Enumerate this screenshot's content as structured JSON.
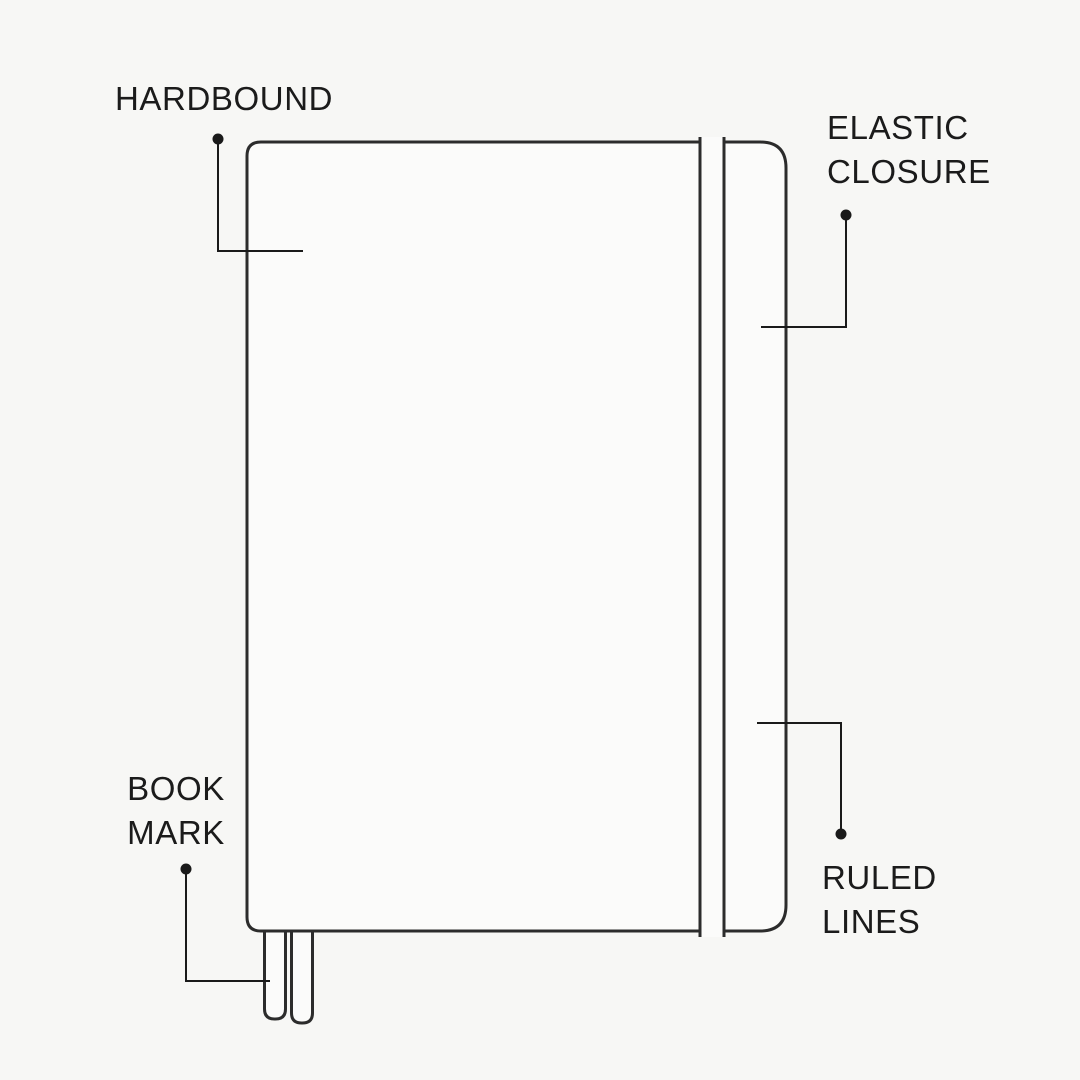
{
  "page": {
    "background_color": "#f7f7f5",
    "drawing_stroke_color": "#2c2c2c",
    "leader_color": "#1a1a1a",
    "text_color": "#1b1b1b",
    "notebook_fill_color": "#fbfbfa"
  },
  "labels": {
    "hardbound": "HARDBOUND",
    "elastic_closure": [
      "ELASTIC",
      "CLOSURE"
    ],
    "book_mark": [
      "BOOK",
      "MARK"
    ],
    "ruled_lines": [
      "RULED",
      "LINES"
    ]
  },
  "diagram_parts": [
    "notebook-cover",
    "elastic-band",
    "bookmark-ribbons",
    "ruled-pages-edge"
  ]
}
